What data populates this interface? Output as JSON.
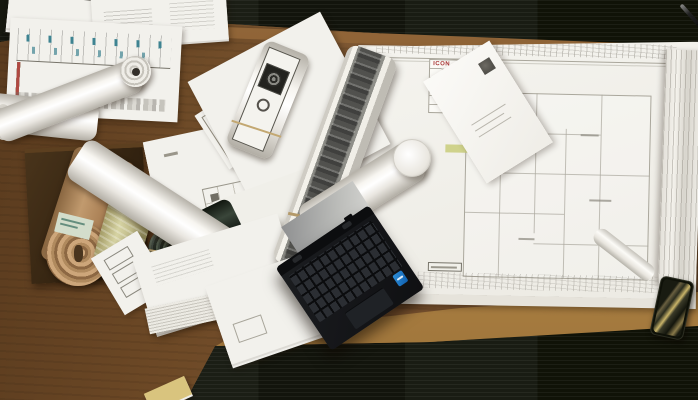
{
  "scene": {
    "description": "Overhead photograph of a wooden architect's desk on dark office carpet, covered with rolled-up drawings, stacks of printed sheets, a large architectural floor plan with a white envelope on it, an open black laptop, and a smartphone lying at the front edge of the desk",
    "view": "top-down"
  },
  "colors": {
    "carpet": "#15170f",
    "wood": "#6e4a26",
    "wood_edge": "#b28749",
    "paper": "#f2f1ec",
    "plan_line": "#aaa79c",
    "highlight_green": "#c9cc7a",
    "intel_blue": "#0f5fae",
    "kraft": "#b08a5e",
    "tracing_roll": "#cfcb96",
    "dark_roll": "#232d22",
    "chart_mark": "#3e8391"
  },
  "floor_plan": {
    "label": "architectural floor plan sheet with pencil elevation sketches along the top margin, green highlighter marks, a revision/title block column and a small red logo",
    "logo_text": "ICON"
  },
  "elevation_chart": {
    "label": "elevation drawing sheet with color-coded vertical bars below a baseline and teal annotation marks above",
    "stripe_colors": [
      "#c9a63a",
      "#8a8a84",
      "#b04840",
      "#3a5f9e",
      "#c9a63a",
      "#9a9a92",
      "#b04840",
      "#3a5f9e",
      "#d4c53a",
      "#55524a",
      "#b04840",
      "#3a5f9e",
      "#c9a63a",
      "#8a8a84",
      "#b04840"
    ],
    "stripe_heights": [
      40,
      34,
      42,
      38,
      30,
      36,
      41,
      33,
      39,
      28,
      40,
      35,
      31,
      42,
      37
    ]
  },
  "objects": [
    {
      "name": "laptop",
      "description": "open black laptop seen from above, keyboard and touchpad visible, blue Intel sticker on right palm rest"
    },
    {
      "name": "smartphone",
      "description": "dark phone with gold-green screen reflections at the desk front edge"
    },
    {
      "name": "envelope",
      "description": "white envelope with dark stamp mark lying diagonally on the floor plan"
    },
    {
      "name": "kraft-roll",
      "description": "tan kraft paper roll with visible spiral end and pale green label"
    },
    {
      "name": "tracing-roll",
      "description": "crinkled yellow-green tracing paper roll"
    },
    {
      "name": "dark-green-roll",
      "description": "glossy dark green rolled print with spiral end, rubber bands and a pencil beside it"
    },
    {
      "name": "white-rolls",
      "description": "several white rolled drawings, one with a grey printed photo band, one with a printed camera-like detail"
    },
    {
      "name": "cardboard-box",
      "description": "dark cardboard tray under the rolls"
    },
    {
      "name": "paper-stacks",
      "description": "stacks of white printed sheets along the top-left and centre-left of the desk"
    },
    {
      "name": "pen",
      "description": "thin pen on the carpet at the top right corner"
    }
  ]
}
